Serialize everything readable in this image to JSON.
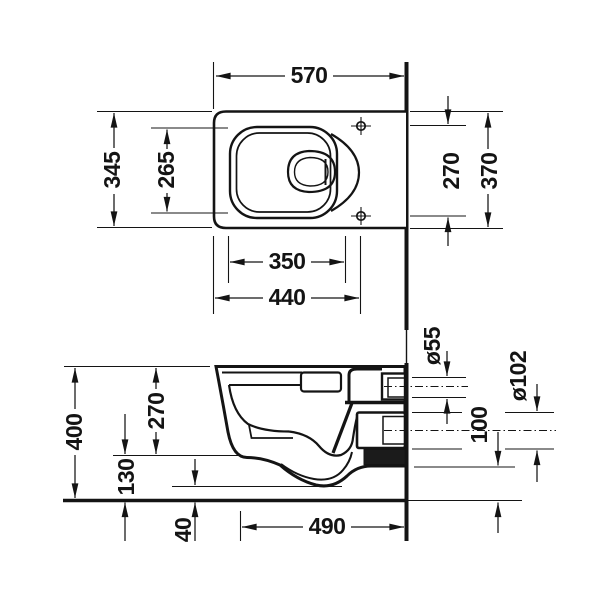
{
  "colors": {
    "ink": "#141414",
    "background": "#ffffff"
  },
  "drawing": {
    "kind": "wall-hung toilet installation drawing",
    "views": [
      "plan view",
      "side section view"
    ]
  },
  "dims": {
    "top": {
      "overall_depth": "570",
      "front_width": "345",
      "bowl_inner_depth": "265",
      "fixing_holes_spacing": "270",
      "rear_width": "370",
      "bowl_width": "350",
      "front_to_fixing_holes": "440"
    },
    "side": {
      "height": "400",
      "body_side_height": "270",
      "bottom_clearance": "130",
      "trap_bottom_clearance": "40",
      "depth_projection": "490",
      "inlet_diameter": "ø55",
      "outlet_diameter": "ø102",
      "outlet_bottom_height": "100"
    }
  }
}
